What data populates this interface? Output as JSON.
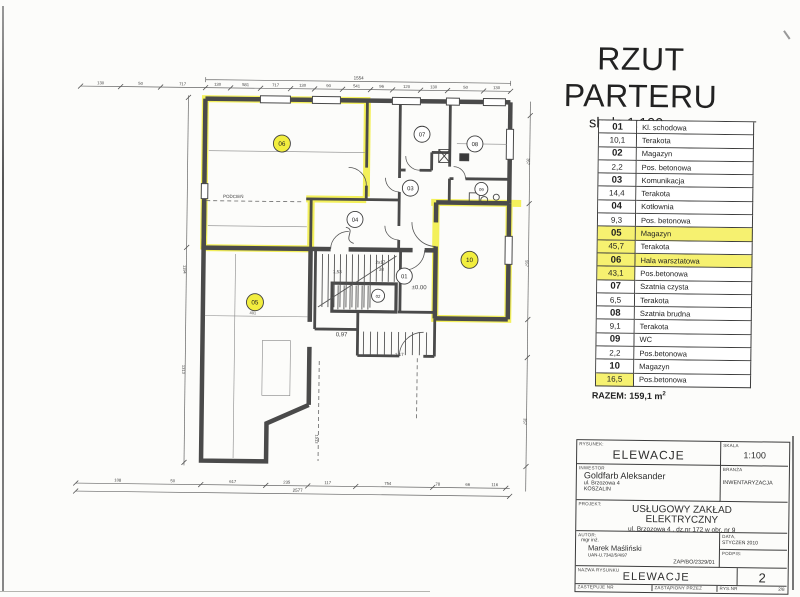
{
  "title": {
    "heading": "RZUT PARTERU",
    "scale": "skala 1:100"
  },
  "legend": {
    "rows": [
      {
        "num": "01",
        "name": "Kl. schodowa",
        "hl_num": false,
        "hl_name": false
      },
      {
        "num": "10,1",
        "name": "Terakota",
        "hl_num": false,
        "hl_name": false
      },
      {
        "num": "02",
        "name": "Magazyn",
        "hl_num": false,
        "hl_name": false
      },
      {
        "num": "2,2",
        "name": "Pos. betonowa",
        "hl_num": false,
        "hl_name": false
      },
      {
        "num": "03",
        "name": "Komunikacja",
        "hl_num": false,
        "hl_name": false
      },
      {
        "num": "14,4",
        "name": "Terakota",
        "hl_num": false,
        "hl_name": false
      },
      {
        "num": "04",
        "name": "Kotłownia",
        "hl_num": false,
        "hl_name": false
      },
      {
        "num": "9,3",
        "name": "Pos. betonowa",
        "hl_num": false,
        "hl_name": false
      },
      {
        "num": "05",
        "name": "Magazyn",
        "hl_num": true,
        "hl_name": true
      },
      {
        "num": "45,7",
        "name": "Terakota",
        "hl_num": true,
        "hl_name": false
      },
      {
        "num": "06",
        "name": "Hala warsztatowa",
        "hl_num": true,
        "hl_name": true
      },
      {
        "num": "43,1",
        "name": "Pos.betonowa",
        "hl_num": true,
        "hl_name": false
      },
      {
        "num": "07",
        "name": "Szatnia czysta",
        "hl_num": false,
        "hl_name": false
      },
      {
        "num": "6,5",
        "name": "Terakota",
        "hl_num": false,
        "hl_name": false
      },
      {
        "num": "08",
        "name": "Szatnia brudna",
        "hl_num": false,
        "hl_name": false
      },
      {
        "num": "9,1",
        "name": "Terakota",
        "hl_num": false,
        "hl_name": false
      },
      {
        "num": "09",
        "name": "WC",
        "hl_num": false,
        "hl_name": false
      },
      {
        "num": "2,2",
        "name": "Pos.betonowa",
        "hl_num": false,
        "hl_name": false
      },
      {
        "num": "10",
        "name": "Magazyn",
        "hl_num": false,
        "hl_name": false
      },
      {
        "num": "16,5",
        "name": "Pos.betonowa",
        "hl_num": true,
        "hl_name": false
      }
    ],
    "total": "RAZEM: 159,1 m",
    "total_sup": "2"
  },
  "plan": {
    "highlight_color": "#f2ee3f",
    "rooms": [
      {
        "id": "01",
        "x": 404,
        "y": 276,
        "r": 8,
        "hl": false
      },
      {
        "id": "02",
        "x": 378,
        "y": 296,
        "r": 6.5,
        "hl": false
      },
      {
        "id": "03",
        "x": 409,
        "y": 188,
        "r": 8,
        "hl": false
      },
      {
        "id": "04",
        "x": 354,
        "y": 220,
        "r": 8,
        "hl": false
      },
      {
        "id": "05",
        "x": 255,
        "y": 304,
        "r": 8.5,
        "hl": true
      },
      {
        "id": "06",
        "x": 280,
        "y": 145,
        "r": 8.5,
        "hl": true
      },
      {
        "id": "07",
        "x": 420,
        "y": 134,
        "r": 8,
        "hl": false
      },
      {
        "id": "08",
        "x": 473,
        "y": 143,
        "r": 8,
        "hl": false
      },
      {
        "id": "09",
        "x": 480,
        "y": 188,
        "r": 6.5,
        "hl": false
      },
      {
        "id": "10",
        "x": 469,
        "y": 259,
        "r": 8.5,
        "hl": true
      }
    ],
    "labels": [
      {
        "t": "PODCIEŃ",
        "x": 232,
        "y": 200,
        "s": 4.5
      },
      {
        "t": "±0.00",
        "x": 419,
        "y": 289,
        "s": 6
      },
      {
        "t": "0,97",
        "x": 342,
        "y": 337,
        "s": 6
      },
      {
        "t": "2x17",
        "x": 380,
        "y": 264,
        "s": 4.5
      },
      {
        "t": "38",
        "x": 381,
        "y": 271,
        "s": 4.5
      },
      {
        "t": "1,53",
        "x": 337,
        "y": 274,
        "s": 4.5
      },
      {
        "t": "1,17",
        "x": 400,
        "y": 356,
        "s": 4.5
      },
      {
        "t": "401",
        "x": 253,
        "y": 316,
        "s": 4
      },
      {
        "t": "1513",
        "x": 317,
        "y": 440,
        "s": 4,
        "r": 90
      },
      {
        "t": "1554",
        "x": 356,
        "y": 80,
        "s": 4.5
      },
      {
        "t": "2577",
        "x": 300,
        "y": 493,
        "s": 4.5
      },
      {
        "t": "1194",
        "x": 183,
        "y": 272,
        "s": 4,
        "r": 90
      },
      {
        "t": "1313",
        "x": 183,
        "y": 372,
        "s": 4,
        "r": 90
      },
      {
        "t": "357",
        "x": 525,
        "y": 160,
        "s": 4,
        "r": 90
      },
      {
        "t": "557",
        "x": 525,
        "y": 262,
        "s": 4,
        "r": 90
      },
      {
        "t": "357",
        "x": 525,
        "y": 420,
        "s": 4,
        "r": 90
      },
      {
        "t": "130",
        "x": 98,
        "y": 88,
        "s": 4.2
      },
      {
        "t": "50",
        "x": 138,
        "y": 88,
        "s": 4.2
      },
      {
        "t": "717",
        "x": 180,
        "y": 88,
        "s": 4.2
      },
      {
        "t": "130",
        "x": 215,
        "y": 88,
        "s": 4.2
      },
      {
        "t": "581",
        "x": 243,
        "y": 88,
        "s": 4.2
      },
      {
        "t": "717",
        "x": 273,
        "y": 88,
        "s": 4.2
      },
      {
        "t": "130",
        "x": 300,
        "y": 88,
        "s": 4.2
      },
      {
        "t": "90",
        "x": 326,
        "y": 88,
        "s": 4.2
      },
      {
        "t": "541",
        "x": 354,
        "y": 88,
        "s": 4.2
      },
      {
        "t": "96",
        "x": 379,
        "y": 88,
        "s": 4.2
      },
      {
        "t": "120",
        "x": 404,
        "y": 88,
        "s": 4.2
      },
      {
        "t": "130",
        "x": 431,
        "y": 88,
        "s": 4.2
      },
      {
        "t": "50",
        "x": 463,
        "y": 88,
        "s": 4.2
      },
      {
        "t": "130",
        "x": 494,
        "y": 88,
        "s": 4.2
      },
      {
        "t": "108",
        "x": 120,
        "y": 485,
        "s": 4.2
      },
      {
        "t": "50",
        "x": 175,
        "y": 485,
        "s": 4.2
      },
      {
        "t": "617",
        "x": 235,
        "y": 485,
        "s": 4.2
      },
      {
        "t": "235",
        "x": 289,
        "y": 485,
        "s": 4.2
      },
      {
        "t": "117",
        "x": 330,
        "y": 485,
        "s": 4.2
      },
      {
        "t": "754",
        "x": 390,
        "y": 485,
        "s": 4.2
      },
      {
        "t": "78",
        "x": 440,
        "y": 485,
        "s": 4.2
      },
      {
        "t": "66",
        "x": 470,
        "y": 485,
        "s": 4.2
      },
      {
        "t": "116",
        "x": 497,
        "y": 485,
        "s": 4.2
      }
    ]
  },
  "titleblock": {
    "drawing_label": "RYSUNEK:",
    "drawing_value": "ELEWACJE",
    "scale_label": "SKALA",
    "scale_value": "1:100",
    "investor_label": "INWESTOR",
    "investor_name": "Goldfarb Aleksander",
    "investor_addr1": "ul. Brzozowa 4",
    "investor_addr2": "KOSZALIN",
    "branch_label": "BRANŻA",
    "branch_value": "INWENTARYZACJA",
    "project_label": "PROJEKT:",
    "project_name1": "USŁUGOWY ZAKŁAD",
    "project_name2": "ELEKTRYCZNY",
    "project_addr": "ul. Brzozowa 4 , dz.nr 172 w obr. nr 9",
    "author_label": "AUTOR:",
    "author_title": "mgr inż.",
    "author_name": "Marek Maśliński",
    "author_lic": "UAN-U.7342/5/4/97",
    "author_ref": "ZAP/BO/2329/01",
    "date_label": "DATA,",
    "date_value": "STYCZEŃ 2010",
    "sign_label": "PODPIS:",
    "name_label": "NAZWA RYSUNKU",
    "name_value": "ELEWACJE",
    "sheet_no": "2",
    "replaces_label": "ZASTĘPUJE NR",
    "replaced_label": "ZASTĄPIONY PRZEZ",
    "rysnr_label": "RYS.NR",
    "rysnr_value": "2/8"
  }
}
